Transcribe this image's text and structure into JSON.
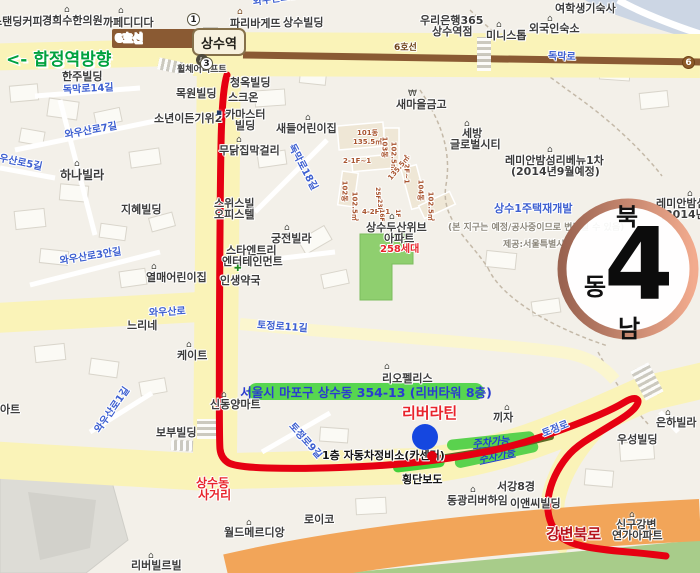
{
  "map": {
    "colors": {
      "label": "#3c3c3c",
      "road_blue": "#3d5fd0",
      "gray": "#8d887c",
      "brick": "#a8542f",
      "red": "#e8242c",
      "deep_red": "#b5121b",
      "route_red": "#e60012",
      "service_olive": "#5e6b25",
      "band_green": "#57d650",
      "parking_green": "#5ad24e",
      "cross_green": "#44d03a",
      "parking_text": "#1f3ed0",
      "address_text": "#2a3bd0",
      "marker_blue": "#1547e0",
      "marker_red": "#e1000e",
      "subway_brown": "#8a5a33",
      "white": "#ffffff"
    },
    "station_label": "상수역",
    "hapjeong_direction": "<- 합정역방향",
    "compass": {
      "north": "북",
      "east": "동",
      "south": "남",
      "arrow": "4"
    },
    "badges": [
      {
        "n": "exit-1-badge",
        "t": "1",
        "x": 193,
        "y": 19
      },
      {
        "n": "exit-3-badge",
        "t": "3",
        "x": 206,
        "y": 63
      },
      {
        "n": "line6-badge",
        "t": "6",
        "x": 688,
        "y": 62,
        "type": "line6"
      }
    ],
    "route": {
      "color": "route_red",
      "width": 7,
      "points": [
        [
          227,
          75
        ],
        [
          222,
          90
        ],
        [
          220,
          200
        ],
        [
          219,
          440
        ],
        [
          221,
          458
        ],
        [
          235,
          467
        ],
        [
          300,
          469
        ],
        [
          380,
          466
        ],
        [
          430,
          461
        ],
        [
          470,
          455
        ],
        [
          505,
          448
        ],
        [
          545,
          436
        ],
        [
          585,
          421
        ],
        [
          615,
          408
        ],
        [
          633,
          397
        ],
        [
          640,
          401
        ],
        [
          631,
          413
        ],
        [
          603,
          430
        ],
        [
          577,
          446
        ],
        [
          563,
          461
        ],
        [
          552,
          481
        ],
        [
          547,
          502
        ],
        [
          549,
          520
        ],
        [
          558,
          536
        ],
        [
          575,
          545
        ],
        [
          605,
          550
        ],
        [
          640,
          553
        ],
        [
          666,
          556
        ]
      ]
    },
    "service_line": {
      "color": "service_olive",
      "width": 6,
      "points": [
        [
          433,
          459
        ],
        [
          505,
          448
        ],
        [
          551,
          437
        ]
      ]
    },
    "markers": [
      {
        "n": "destination-marker",
        "x": 425,
        "y": 437,
        "r": 13,
        "c": "marker_blue"
      },
      {
        "n": "carcenter-marker",
        "x": 432,
        "y": 456,
        "r": 5,
        "c": "marker_red"
      }
    ],
    "bands": [
      {
        "n": "address-highlight",
        "t": "서울시 마포구 상수동 354-13 (리버타워 8층)",
        "x": 248,
        "y": 383,
        "w": 236,
        "h": 17,
        "r": 0,
        "bg": "band_green",
        "tc": "address_text",
        "fs": 12.5,
        "z": 7
      },
      {
        "n": "parking-highlight",
        "t": "주차가능",
        "x": 447,
        "y": 440,
        "w": 88,
        "h": 11,
        "r": -6,
        "bg": "parking_green",
        "tc": "parking_text",
        "fs": 10,
        "z": 3,
        "italic": true,
        "underline": true
      },
      {
        "n": "parking-highlight",
        "t": "주차가능",
        "x": 455,
        "y": 458,
        "w": 85,
        "h": 11,
        "r": -12,
        "bg": "parking_green",
        "tc": "parking_text",
        "fs": 10,
        "z": 3,
        "italic": true,
        "underline": true
      },
      {
        "n": "crosswalk-highlight",
        "t": "",
        "x": 393,
        "y": 463,
        "w": 52,
        "h": 10,
        "r": -7,
        "bg": "cross_green",
        "tc": "parking_text",
        "fs": 9,
        "z": 3
      }
    ],
    "labels": [
      {
        "t": "스탠딩커피",
        "x": -8,
        "y": 16
      },
      {
        "t": "경희수한의원",
        "x": 42,
        "y": 15
      },
      {
        "t": "까페디디다",
        "x": 103,
        "y": 17
      },
      {
        "t": "파리바게뜨",
        "x": 230,
        "y": 18
      },
      {
        "t": "상수빌딩",
        "x": 283,
        "y": 17
      },
      {
        "t": "우리은행365",
        "x": 420,
        "y": 15
      },
      {
        "t": "상수역점",
        "x": 432,
        "y": 26
      },
      {
        "t": "여학생기숙사",
        "x": 555,
        "y": 3
      },
      {
        "t": "외국인숙소",
        "x": 529,
        "y": 23
      },
      {
        "t": "미니스톱",
        "x": 486,
        "y": 30
      },
      {
        "t": "6호선",
        "x": 115,
        "y": 33,
        "fs": 11,
        "c": "white",
        "z": 6
      },
      {
        "t": "6호선",
        "x": 394,
        "y": 44,
        "fs": 9,
        "c": "#6e4218",
        "z": 6
      },
      {
        "t": "독막로",
        "x": 548,
        "y": 52,
        "fs": 10,
        "c": "road_blue",
        "r": 2
      },
      {
        "t": "휠체어리프트",
        "x": 177,
        "y": 66,
        "fs": 9
      },
      {
        "t": "한주빌딩",
        "x": 62,
        "y": 71
      },
      {
        "t": "청옥빌딩",
        "x": 230,
        "y": 77
      },
      {
        "t": "목원빌딩",
        "x": 176,
        "y": 88
      },
      {
        "t": "스크온",
        "x": 228,
        "y": 92,
        "z": 3
      },
      {
        "t": "독막로14길",
        "x": 63,
        "y": 86,
        "fs": 10,
        "c": "road_blue",
        "r": -3
      },
      {
        "t": "새마을금고",
        "x": 396,
        "y": 99
      },
      {
        "t": "와우산로10길",
        "x": 253,
        "y": -2,
        "fs": 10,
        "c": "road_blue",
        "r": -8
      },
      {
        "t": "소년이든기위2",
        "x": 154,
        "y": 113
      },
      {
        "t": "카마스터",
        "x": 225,
        "y": 109
      },
      {
        "t": "빌딩",
        "x": 235,
        "y": 120
      },
      {
        "t": "와우산로7길",
        "x": 65,
        "y": 131,
        "fs": 10,
        "c": "road_blue",
        "r": -10
      },
      {
        "t": "와우산로5길",
        "x": -10,
        "y": 152,
        "fs": 10,
        "c": "road_blue",
        "r": 12
      },
      {
        "t": "무닭집막걸리",
        "x": 219,
        "y": 145
      },
      {
        "t": "새들어린이집",
        "x": 276,
        "y": 123
      },
      {
        "t": "독막로18길",
        "x": 290,
        "y": 140,
        "fs": 10,
        "c": "road_blue",
        "r": 62
      },
      {
        "t": "101동",
        "x": 357,
        "y": 130,
        "fs": 7,
        "c": "brick"
      },
      {
        "t": "135.5㎡",
        "x": 353,
        "y": 139,
        "fs": 7,
        "c": "brick"
      },
      {
        "t": "103동",
        "x": 384,
        "y": 133,
        "fs": 7,
        "c": "brick",
        "r": 90
      },
      {
        "t": "102.5㎡",
        "x": 393,
        "y": 138,
        "fs": 7,
        "c": "brick",
        "r": 90
      },
      {
        "t": "2-1F~1",
        "x": 343,
        "y": 158,
        "fs": 7,
        "c": "brick"
      },
      {
        "t": "2-2F~1",
        "x": 406,
        "y": 152,
        "fs": 7,
        "c": "brick",
        "r": 90
      },
      {
        "t": "135.5㎡",
        "x": 390,
        "y": 176,
        "fs": 7,
        "c": "brick",
        "r": -50
      },
      {
        "t": "102동",
        "x": 344,
        "y": 177,
        "fs": 7,
        "c": "brick",
        "r": 90
      },
      {
        "t": "102.5㎡",
        "x": 354,
        "y": 188,
        "fs": 7,
        "c": "brick",
        "r": 90
      },
      {
        "t": "104동",
        "x": 420,
        "y": 176,
        "fs": 7,
        "c": "brick",
        "r": 90
      },
      {
        "t": "102.5㎡",
        "x": 430,
        "y": 188,
        "fs": 7,
        "c": "brick",
        "r": 90
      },
      {
        "t": "4-2F~1",
        "x": 362,
        "y": 209,
        "fs": 7,
        "c": "brick"
      },
      {
        "t": "25F",
        "x": 377,
        "y": 184,
        "fs": 6,
        "c": "brick",
        "r": 90
      },
      {
        "t": "23F",
        "x": 379,
        "y": 196,
        "fs": 6,
        "c": "brick",
        "r": 90
      },
      {
        "t": "16F",
        "x": 381,
        "y": 206,
        "fs": 6,
        "c": "brick",
        "r": 90
      },
      {
        "t": "1F",
        "x": 397,
        "y": 206,
        "fs": 6,
        "c": "brick",
        "r": 90
      },
      {
        "t": "세방",
        "x": 462,
        "y": 128
      },
      {
        "t": "글로벌시티",
        "x": 450,
        "y": 139
      },
      {
        "t": "레미안밤섬리베뉴1차",
        "x": 505,
        "y": 155
      },
      {
        "t": "(2014년9월예정)",
        "x": 511,
        "y": 166
      },
      {
        "t": "레미안밤섬리",
        "x": 656,
        "y": 198
      },
      {
        "t": "(2014년9월",
        "x": 660,
        "y": 209
      },
      {
        "t": "하나빌라",
        "x": 60,
        "y": 169,
        "fs": 12
      },
      {
        "t": "지혜빌딩",
        "x": 121,
        "y": 204
      },
      {
        "t": "스위스빌",
        "x": 214,
        "y": 198,
        "z": 3
      },
      {
        "t": "오피스텔",
        "x": 214,
        "y": 209,
        "z": 3
      },
      {
        "t": "궁전빌라",
        "x": 271,
        "y": 233
      },
      {
        "t": "상수두산위브",
        "x": 366,
        "y": 222
      },
      {
        "t": "아파트",
        "x": 384,
        "y": 233
      },
      {
        "t": "258세대",
        "x": 380,
        "y": 245,
        "fs": 10,
        "c": "red"
      },
      {
        "t": "상수1주택재개발",
        "x": 494,
        "y": 203,
        "fs": 11,
        "c": "road_blue"
      },
      {
        "t": "(본 지구는 예정/공사중이므로 변경될 수 있음)",
        "x": 448,
        "y": 224,
        "fs": 9,
        "c": "gray"
      },
      {
        "t": "제공:서울특별시",
        "x": 503,
        "y": 241,
        "fs": 9,
        "c": "gray"
      },
      {
        "t": "스타엔트리",
        "x": 226,
        "y": 245,
        "z": 3
      },
      {
        "t": "엔터테인먼트",
        "x": 222,
        "y": 256,
        "z": 3
      },
      {
        "t": "인생약국",
        "x": 220,
        "y": 275,
        "z": 3
      },
      {
        "t": "와우산로3안길",
        "x": 60,
        "y": 257,
        "fs": 10,
        "c": "road_blue",
        "r": -9
      },
      {
        "t": "열매어린이집",
        "x": 146,
        "y": 272
      },
      {
        "t": "와우산로",
        "x": 149,
        "y": 309,
        "fs": 10,
        "c": "road_blue",
        "r": -3
      },
      {
        "t": "느리네",
        "x": 127,
        "y": 320
      },
      {
        "t": "토정로11길",
        "x": 257,
        "y": 321,
        "fs": 10,
        "c": "road_blue",
        "r": 4
      },
      {
        "t": "케이트",
        "x": 177,
        "y": 350
      },
      {
        "t": "리오펠리스",
        "x": 382,
        "y": 373
      },
      {
        "t": "아트",
        "x": 0,
        "y": 404
      },
      {
        "t": "신동양마트",
        "x": 210,
        "y": 399
      },
      {
        "t": "와우산로1길",
        "x": 98,
        "y": 427,
        "fs": 10,
        "c": "road_blue",
        "r": -55
      },
      {
        "t": "보부빌딩",
        "x": 156,
        "y": 427
      },
      {
        "t": "토정로9길",
        "x": 290,
        "y": 420,
        "fs": 10,
        "c": "road_blue",
        "r": 48
      },
      {
        "t": "리버라틴",
        "x": 402,
        "y": 406,
        "fs": 15,
        "c": "red",
        "z": 7
      },
      {
        "t": "1층 자동차정비소(카센터)",
        "x": 322,
        "y": 450,
        "fs": 11,
        "c": "#141414",
        "z": 7
      },
      {
        "t": "횡단보도",
        "x": 402,
        "y": 474,
        "fs": 11,
        "c": "#141414",
        "z": 7
      },
      {
        "t": "끼자",
        "x": 493,
        "y": 412
      },
      {
        "t": "토정로",
        "x": 543,
        "y": 430,
        "fs": 10,
        "c": "road_blue",
        "r": -22
      },
      {
        "t": "우성빌딩",
        "x": 617,
        "y": 434
      },
      {
        "t": "은하빌라",
        "x": 656,
        "y": 417
      },
      {
        "t": "상수동",
        "x": 196,
        "y": 477,
        "fs": 12,
        "c": "red",
        "z": 6
      },
      {
        "t": "사거리",
        "x": 198,
        "y": 489,
        "fs": 12,
        "c": "red",
        "z": 6
      },
      {
        "t": "서강8경",
        "x": 497,
        "y": 481
      },
      {
        "t": "동광리버하임",
        "x": 447,
        "y": 495
      },
      {
        "t": "이앤씨빌딩",
        "x": 510,
        "y": 498,
        "z": 3
      },
      {
        "t": "신구강변",
        "x": 616,
        "y": 519
      },
      {
        "t": "연가아파트",
        "x": 612,
        "y": 530
      },
      {
        "t": "로이코",
        "x": 304,
        "y": 514
      },
      {
        "t": "월드메르디앙",
        "x": 224,
        "y": 527
      },
      {
        "t": "리버빌르빌",
        "x": 131,
        "y": 560
      },
      {
        "t": "강변북로",
        "x": 546,
        "y": 527,
        "fs": 15,
        "c": "deep_red",
        "z": 7
      }
    ],
    "poi_icons": [
      {
        "g": "⌂",
        "x": 64,
        "y": 6
      },
      {
        "g": "⌂",
        "x": 118,
        "y": 7
      },
      {
        "g": "⌂",
        "x": 237,
        "y": 8,
        "c": "#7a4a20"
      },
      {
        "g": "⌂",
        "x": 547,
        "y": 15
      },
      {
        "g": "⌂",
        "x": 496,
        "y": 21
      },
      {
        "g": "₩",
        "x": 408,
        "y": 90
      },
      {
        "g": "▪",
        "x": 216,
        "y": 109,
        "c": "#223a66"
      },
      {
        "g": "⌂",
        "x": 236,
        "y": 136
      },
      {
        "g": "⌂",
        "x": 305,
        "y": 114
      },
      {
        "g": "⌂",
        "x": 464,
        "y": 120
      },
      {
        "g": "⌂",
        "x": 547,
        "y": 146
      },
      {
        "g": "⌂",
        "x": 687,
        "y": 190
      },
      {
        "g": "⌂",
        "x": 74,
        "y": 160
      },
      {
        "g": "⌂",
        "x": 284,
        "y": 224
      },
      {
        "g": "✚",
        "x": 234,
        "y": 265,
        "c": "#1e8a1e"
      },
      {
        "g": "⌂",
        "x": 389,
        "y": 213
      },
      {
        "g": "⌂",
        "x": 151,
        "y": 263
      },
      {
        "g": "⌂",
        "x": 186,
        "y": 341
      },
      {
        "g": "⌂",
        "x": 384,
        "y": 363
      },
      {
        "g": "⌂",
        "x": 221,
        "y": 391
      },
      {
        "g": "⌂",
        "x": 504,
        "y": 404
      },
      {
        "g": "⌂",
        "x": 665,
        "y": 409
      },
      {
        "g": "⌂",
        "x": 470,
        "y": 486
      },
      {
        "g": "⌂",
        "x": 629,
        "y": 511
      },
      {
        "g": "⌂",
        "x": 246,
        "y": 519
      },
      {
        "g": "⌂",
        "x": 148,
        "y": 552
      }
    ],
    "wheelchair_lift": {
      "glyph": "♿",
      "x": 196,
      "y": 54
    }
  }
}
